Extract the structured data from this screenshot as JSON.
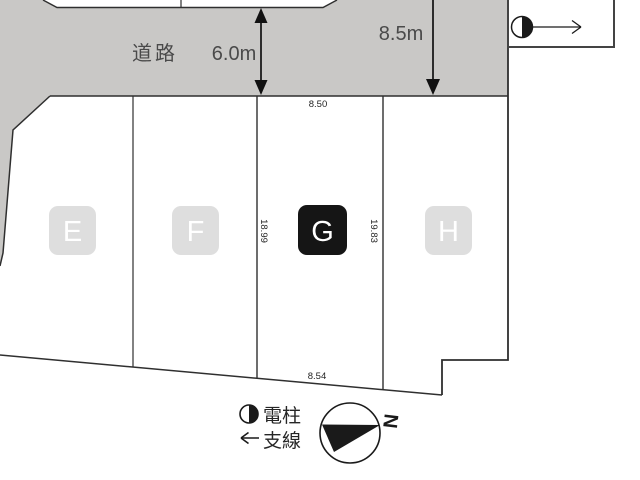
{
  "diagram": {
    "road": {
      "label": "道路",
      "width": "6.0m",
      "side_width": "8.5m"
    },
    "lots": {
      "e": "E",
      "f": "F",
      "g": "G",
      "h": "H"
    },
    "dimensions": {
      "top": "8.50",
      "left": "18.99",
      "right": "19.83",
      "bottom": "8.54"
    },
    "legend": {
      "pole_label": "電柱",
      "guy_label": "支線",
      "pole_symbol": "half-filled-circle",
      "guy_symbol": "left-arrow"
    },
    "compass": {
      "north": "N"
    }
  },
  "colors": {
    "road": "#c9c8c6",
    "line": "#2f2f2f",
    "chip_bg": "#dedede",
    "chip_selected_bg": "#151515",
    "chip_text": "#ffffff"
  }
}
